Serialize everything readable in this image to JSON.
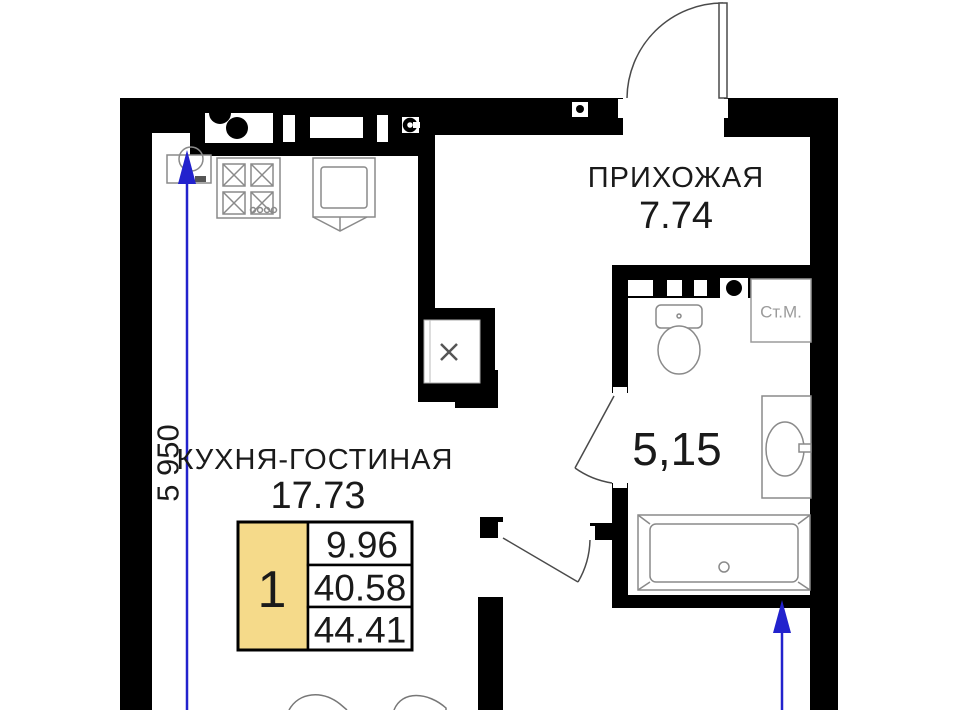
{
  "plan": {
    "hallway": {
      "name": "ПРИХОЖАЯ",
      "area": "7.74"
    },
    "kitchen_living": {
      "name": "КУХНЯ-ГОСТИНАЯ",
      "area": "17.73"
    },
    "bathroom": {
      "area": "5,15"
    }
  },
  "fixtures": {
    "washing_machine_label": "Ст.М."
  },
  "dimensions": {
    "left_wall_length": "5 950"
  },
  "summary_table": {
    "rooms_count": "1",
    "values": [
      "9.96",
      "40.58",
      "44.41"
    ]
  },
  "colors": {
    "wall": "#000000",
    "dimension_blue": "#2222cd",
    "highlight_yellow": "#f5da8a",
    "fixture_gray": "#8a8a8a",
    "label_gray": "#9b9b9b"
  }
}
